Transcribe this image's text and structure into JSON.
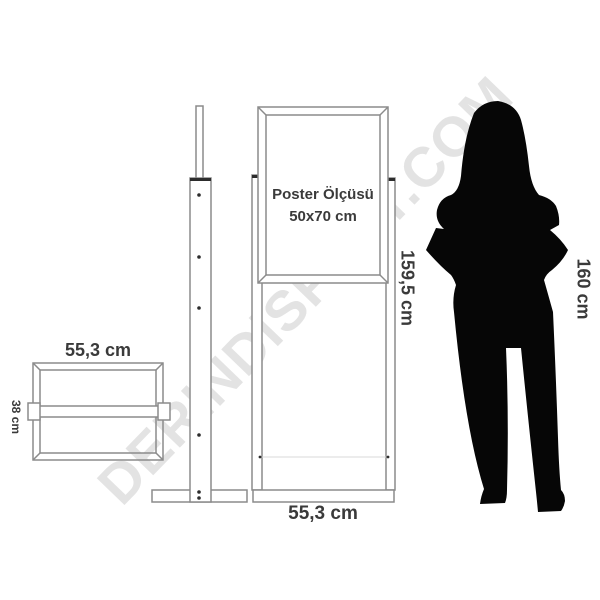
{
  "colors": {
    "background": "#ffffff",
    "line": "#8b8b8b",
    "line_dark": "#2c2c2c",
    "text": "#3a3a3a",
    "text_light": "#d9d9d9",
    "watermark": "#e3e3e3",
    "silhouette": "#060606"
  },
  "watermark": {
    "text": "DERINDiSPLAY.COM"
  },
  "base_top_view": {
    "width_label": "55,3 cm",
    "depth_label": "38 cm"
  },
  "stand_front_view": {
    "poster_size_title": "Poster Ölçüsü",
    "poster_size_value": "50x70 cm",
    "height_label": "159,5 cm",
    "width_label": "55,3 cm"
  },
  "person": {
    "height_label": "160 cm"
  }
}
